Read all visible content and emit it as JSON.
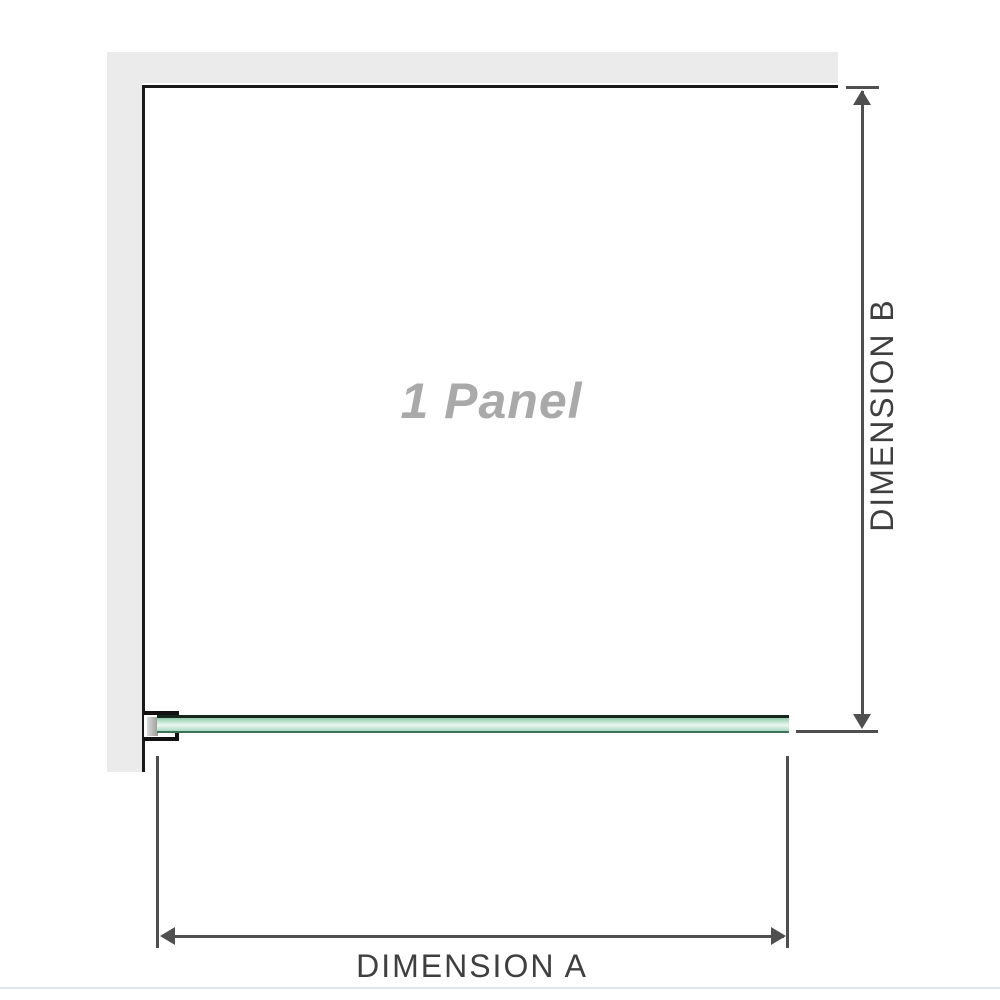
{
  "diagram": {
    "panel_label": "1 Panel",
    "dimension_a_label": "DIMENSION A",
    "dimension_b_label": "DIMENSION B"
  },
  "colors": {
    "wall": "#ebebeb",
    "frame_border": "#1a1a1a",
    "dimension_line": "#4f4f4f",
    "label_text": "#3f3f3f",
    "panel_label_text": "#a9a9a9",
    "glass_fill": "#a9dcc2",
    "glass_fill_light": "#ecf7f1",
    "glass_border": "#16281e",
    "bracket_border": "#121212",
    "baseline_line": "#e2e6e9"
  }
}
